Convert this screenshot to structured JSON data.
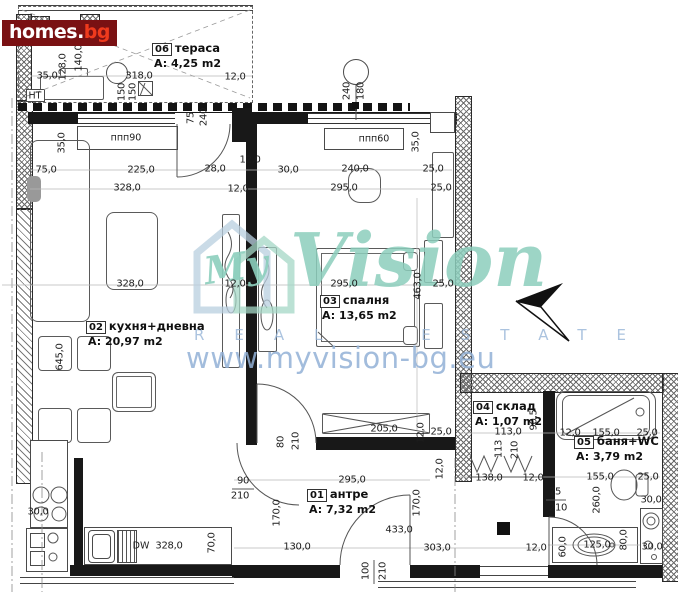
{
  "branding": {
    "logo_name": "homes",
    "logo_dot": ".",
    "logo_tld": "bg",
    "logo_bg_color": "#7a1113",
    "logo_tld_color": "#ef3a1d"
  },
  "watermark": {
    "script_prefix": "My",
    "script": "Vision",
    "letters": "REAL ESTATE",
    "url": "www.myvision-bg.eu",
    "teal": "#8cceba",
    "blue": "#92b0d6"
  },
  "plan": {
    "rooms": [
      {
        "number": "06",
        "name": "тераса",
        "area": "A: 4,25 m2",
        "x": 152,
        "y": 41
      },
      {
        "number": "02",
        "name": "кухня+дневна",
        "area": "A: 20,97 m2",
        "x": 86,
        "y": 319
      },
      {
        "number": "03",
        "name": "спалня",
        "area": "A: 13,65 m2",
        "x": 320,
        "y": 293
      },
      {
        "number": "01",
        "name": "антре",
        "area": "A: 7,32 m2",
        "x": 307,
        "y": 487
      },
      {
        "number": "04",
        "name": "склад",
        "area": "A: 1,07 m2",
        "x": 473,
        "y": 399
      },
      {
        "number": "05",
        "name": "баня+WC",
        "area": "A: 3,79 m2",
        "x": 574,
        "y": 434
      }
    ],
    "annotations": [
      {
        "text": "ппп90",
        "x": 126,
        "y": 138
      },
      {
        "text": "ппп60",
        "x": 374,
        "y": 139
      },
      {
        "text": "НТ",
        "x": 35,
        "y": 96
      },
      {
        "text": "DW",
        "x": 141,
        "y": 546
      }
    ],
    "dimensions": [
      {
        "text": "35,0",
        "x": 47,
        "y": 76
      },
      {
        "text": "318,0",
        "x": 139,
        "y": 76
      },
      {
        "text": "12,0",
        "x": 235,
        "y": 77
      },
      {
        "text": "128,0",
        "x": 63,
        "y": 67,
        "v": true
      },
      {
        "text": "140,0",
        "x": 79,
        "y": 58,
        "v": true
      },
      {
        "text": "150",
        "x": 122,
        "y": 92,
        "v": true
      },
      {
        "text": "150",
        "x": 133,
        "y": 92,
        "v": true
      },
      {
        "text": "75",
        "x": 191,
        "y": 118,
        "v": true
      },
      {
        "text": "240",
        "x": 204,
        "y": 117,
        "v": true
      },
      {
        "text": "240",
        "x": 347,
        "y": 91,
        "v": true
      },
      {
        "text": "180",
        "x": 361,
        "y": 91,
        "v": true
      },
      {
        "text": "75,0",
        "x": 46,
        "y": 170
      },
      {
        "text": "225,0",
        "x": 141,
        "y": 170
      },
      {
        "text": "28,0",
        "x": 215,
        "y": 169
      },
      {
        "text": "30,0",
        "x": 288,
        "y": 170
      },
      {
        "text": "240,0",
        "x": 355,
        "y": 169
      },
      {
        "text": "25,0",
        "x": 433,
        "y": 169
      },
      {
        "text": "328,0",
        "x": 127,
        "y": 188
      },
      {
        "text": "12,0",
        "x": 250,
        "y": 160
      },
      {
        "text": "12,0",
        "x": 238,
        "y": 189
      },
      {
        "text": "295,0",
        "x": 344,
        "y": 188
      },
      {
        "text": "25,0",
        "x": 441,
        "y": 188
      },
      {
        "text": "35,0",
        "x": 62,
        "y": 143,
        "v": true
      },
      {
        "text": "35,0",
        "x": 416,
        "y": 142,
        "v": true
      },
      {
        "text": "328,0",
        "x": 130,
        "y": 284
      },
      {
        "text": "12,0",
        "x": 235,
        "y": 284
      },
      {
        "text": "295,0",
        "x": 344,
        "y": 284
      },
      {
        "text": "25,0",
        "x": 443,
        "y": 284
      },
      {
        "text": "463,0",
        "x": 418,
        "y": 286,
        "v": true
      },
      {
        "text": "645,0",
        "x": 60,
        "y": 357,
        "v": true
      },
      {
        "text": "30,0",
        "x": 38,
        "y": 512
      },
      {
        "text": "328,0",
        "x": 169,
        "y": 546
      },
      {
        "text": "70,0",
        "x": 212,
        "y": 543,
        "v": true
      },
      {
        "text": "80",
        "x": 281,
        "y": 442,
        "v": true
      },
      {
        "text": "210",
        "x": 296,
        "y": 441,
        "v": true
      },
      {
        "text": "90",
        "x": 243,
        "y": 481
      },
      {
        "text": "210",
        "x": 240,
        "y": 496
      },
      {
        "text": "170,0",
        "x": 277,
        "y": 513,
        "v": true
      },
      {
        "text": "295,0",
        "x": 352,
        "y": 480
      },
      {
        "text": "170,0",
        "x": 417,
        "y": 503,
        "v": true
      },
      {
        "text": "12,0",
        "x": 440,
        "y": 469,
        "v": true
      },
      {
        "text": "433,0",
        "x": 399,
        "y": 530
      },
      {
        "text": "130,0",
        "x": 297,
        "y": 547
      },
      {
        "text": "100",
        "x": 366,
        "y": 571,
        "v": true
      },
      {
        "text": "210",
        "x": 383,
        "y": 571,
        "v": true
      },
      {
        "text": "303,0",
        "x": 437,
        "y": 548
      },
      {
        "text": "12,0",
        "x": 536,
        "y": 548
      },
      {
        "text": "205,0",
        "x": 384,
        "y": 429
      },
      {
        "text": "25,0",
        "x": 441,
        "y": 432
      },
      {
        "text": "12,0",
        "x": 421,
        "y": 433,
        "v": true
      },
      {
        "text": "113,0",
        "x": 508,
        "y": 432
      },
      {
        "text": "113",
        "x": 499,
        "y": 449,
        "v": true
      },
      {
        "text": "210",
        "x": 515,
        "y": 450,
        "v": true
      },
      {
        "text": "90,5",
        "x": 534,
        "y": 420,
        "v": true
      },
      {
        "text": "138,0",
        "x": 489,
        "y": 478
      },
      {
        "text": "12,0",
        "x": 533,
        "y": 478
      },
      {
        "text": "12,0",
        "x": 570,
        "y": 433
      },
      {
        "text": "155,0",
        "x": 606,
        "y": 433
      },
      {
        "text": "25,0",
        "x": 647,
        "y": 433
      },
      {
        "text": "155,0",
        "x": 600,
        "y": 477
      },
      {
        "text": "25,0",
        "x": 648,
        "y": 477
      },
      {
        "text": "75",
        "x": 555,
        "y": 492
      },
      {
        "text": "210",
        "x": 558,
        "y": 508
      },
      {
        "text": "260,0",
        "x": 597,
        "y": 500,
        "v": true
      },
      {
        "text": "30,0",
        "x": 651,
        "y": 500
      },
      {
        "text": "60,0",
        "x": 563,
        "y": 547,
        "v": true
      },
      {
        "text": "125,0",
        "x": 597,
        "y": 545
      },
      {
        "text": "80,0",
        "x": 624,
        "y": 540,
        "v": true
      },
      {
        "text": "30,0",
        "x": 652,
        "y": 547
      }
    ]
  }
}
